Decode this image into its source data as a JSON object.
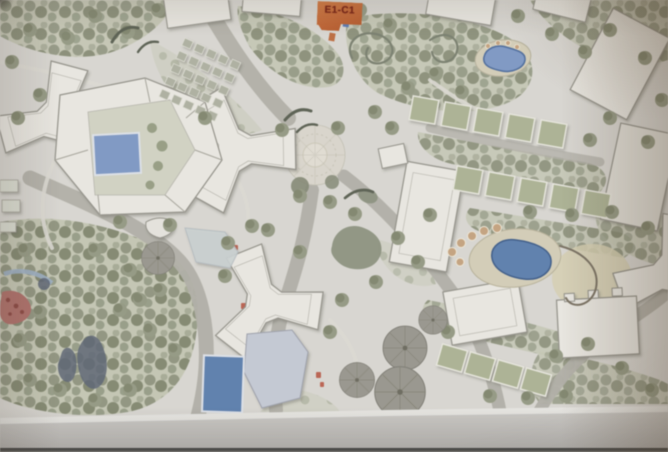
{
  "photo": {
    "tag": {
      "label": "E1-C1",
      "bg": "#cd6a34",
      "text": "#7c1f10"
    },
    "plan": {
      "colors": {
        "paper": "#dbd9d3",
        "margin": "#c9c7c3",
        "building": "#ebe9e2",
        "outline": "#96948b",
        "foliage": "#8f957e",
        "canopy": "#9b9990",
        "road": "#b4b2a9",
        "lawn": "#c6c8b4",
        "unit_roof": "#aeb594",
        "pool": "#7f9bca",
        "pool_deep": "#5d82b4",
        "pond": "#5f6878",
        "stream": "#9fb3c9",
        "deck": "#d6cfb8",
        "sand": "#d8d1b2",
        "flower": "#b5716b",
        "accent_red": "#c05844",
        "pale_building": "#c6cbd6",
        "glass": "#ccd4d4"
      }
    }
  }
}
